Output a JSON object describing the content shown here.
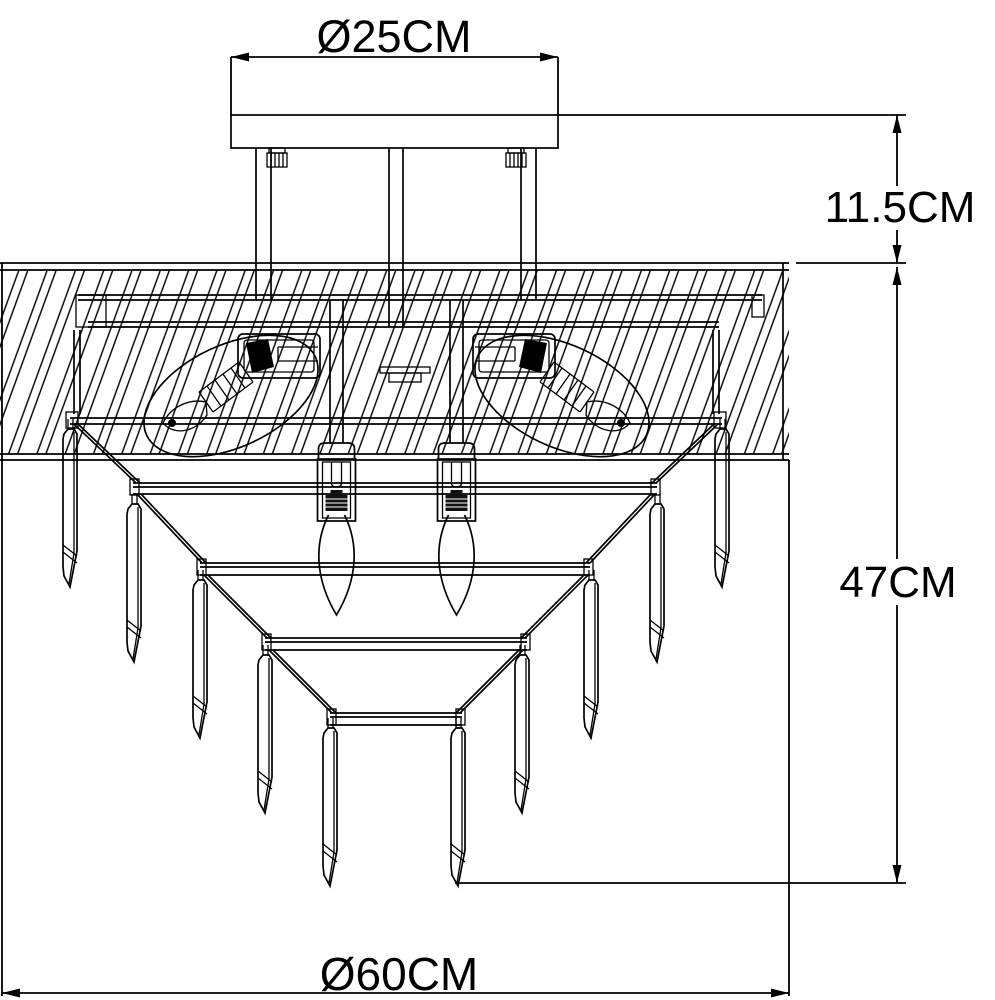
{
  "figure": {
    "type": "technical-dimension-drawing",
    "subject": "ceiling-light-fixture",
    "background": "#ffffff",
    "line_color": "#000000",
    "labels": {
      "top_diameter": "Ø25CM",
      "drop_height": "11.5CM",
      "body_height": "47CM",
      "body_diameter": "Ø60CM"
    }
  }
}
